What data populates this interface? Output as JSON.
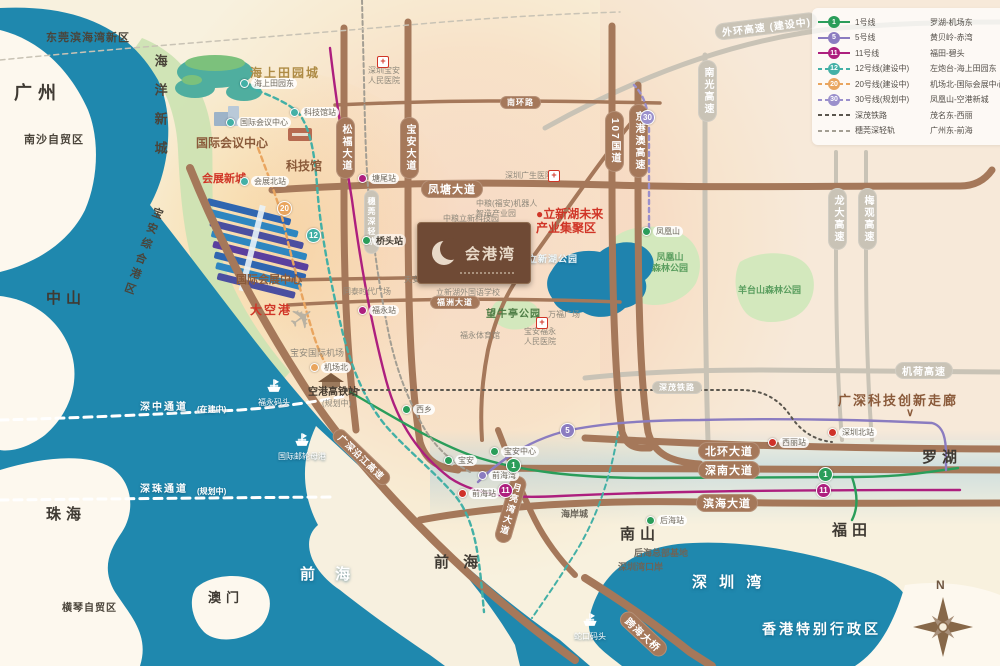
{
  "palette": {
    "sea": "#1f88ae",
    "land": "#f8f1de",
    "road_brown": "#a5785a",
    "road_gray": "#c9c3b6",
    "line1": "#2a9d5a",
    "line5": "#8b7cc0",
    "line11": "#ad1f7e",
    "line12": "#43b0a6",
    "line20": "#e9a55f",
    "line30": "#9b90cc",
    "rail_shenmao": "#5a564e",
    "rail_suiwan": "#a39e93",
    "highlight_red": "#d03527"
  },
  "logo": {
    "title": "会港湾"
  },
  "legend": {
    "rows": [
      {
        "badge": "1",
        "name": "1号线",
        "route": "罗湖-机场东",
        "c": "#2a9d5a",
        "cls": ""
      },
      {
        "badge": "5",
        "name": "5号线",
        "route": "黄贝岭-赤湾",
        "c": "#8b7cc0",
        "cls": ""
      },
      {
        "badge": "11",
        "name": "11号线",
        "route": "福田-碧头",
        "c": "#ad1f7e",
        "cls": ""
      },
      {
        "badge": "12",
        "name": "12号线(建设中)",
        "route": "左炮台-海上田园东",
        "c": "#43b0a6",
        "cls": "lg-dash"
      },
      {
        "badge": "20",
        "name": "20号线(建设中)",
        "route": "机场北-国际会展中心",
        "c": "#e9a55f",
        "cls": "lg-dash"
      },
      {
        "badge": "30",
        "name": "30号线(规划中)",
        "route": "凤凰山-空港新城",
        "c": "#9b90cc",
        "cls": "lg-dash"
      },
      {
        "badge": "",
        "name": "深茂铁路",
        "route": "茂名东-西丽",
        "c": "#5a564e",
        "cls": "lg-dash"
      },
      {
        "badge": "",
        "name": "穗莞深轻轨",
        "route": "广州东-前海",
        "c": "#a39e93",
        "cls": "lg-dash"
      }
    ]
  },
  "map_labels": [
    {
      "t": "东莞滨海湾新区",
      "x": 46,
      "y": 32,
      "cls": "dark-md"
    },
    {
      "t": "广州",
      "x": 14,
      "y": 83,
      "cls": "city-xl"
    },
    {
      "t": "南沙自贸区",
      "x": 24,
      "y": 134,
      "cls": "dark-md"
    },
    {
      "t": "中山",
      "x": 46,
      "y": 290,
      "cls": "city-lg"
    },
    {
      "t": "珠海",
      "x": 46,
      "y": 506,
      "cls": "city-lg"
    },
    {
      "t": "横琴自贸区",
      "x": 62,
      "y": 603,
      "cls": "dark-md",
      "fs": 10
    },
    {
      "t": "澳门",
      "x": 208,
      "y": 590,
      "cls": "city-lg",
      "fs": 13
    },
    {
      "t": "前 海",
      "x": 300,
      "y": 566,
      "cls": "white-lg"
    },
    {
      "t": "前 海",
      "x": 434,
      "y": 554,
      "cls": "city-lg"
    },
    {
      "t": "南山",
      "x": 620,
      "y": 526,
      "cls": "city-lg"
    },
    {
      "t": "福田",
      "x": 832,
      "y": 522,
      "cls": "city-lg"
    },
    {
      "t": "罗湖",
      "x": 922,
      "y": 449,
      "cls": "city-lg"
    },
    {
      "t": "深 圳 湾",
      "x": 692,
      "y": 574,
      "cls": "white-lg",
      "ls": 4
    },
    {
      "t": "香港特别行政区",
      "x": 762,
      "y": 621,
      "cls": "white-lg",
      "fs": 14,
      "ls": 3
    },
    {
      "t": "海洋新城",
      "x": 152,
      "y": 54,
      "cls": "vert-city"
    },
    {
      "t": "宝安综合港区",
      "x": 152,
      "y": 205,
      "cls": "vert-city",
      "rot": 20,
      "fs": 11,
      "ls": 5
    },
    {
      "t": "会展新城",
      "x": 202,
      "y": 173,
      "cls": "red-bold",
      "fs": 11
    },
    {
      "t": "大空港",
      "x": 250,
      "y": 303,
      "cls": "red-bold",
      "ls": 2
    },
    {
      "t": "●立新湖未来\n产业集聚区",
      "x": 536,
      "y": 207,
      "cls": "red-bold"
    },
    {
      "t": "海上田园城",
      "x": 250,
      "y": 66,
      "cls": "gold-bold"
    },
    {
      "t": "国际会议中心",
      "x": 196,
      "y": 136,
      "cls": "brown-bold"
    },
    {
      "t": "科技馆",
      "x": 286,
      "y": 159,
      "cls": "brown-bold"
    },
    {
      "t": "国际会展中心",
      "x": 236,
      "y": 274,
      "cls": "brown-bold",
      "fs": 11
    },
    {
      "t": "望牛亭公园",
      "x": 486,
      "y": 309,
      "cls": "park-strong"
    },
    {
      "t": "凤凰山\n森林公园",
      "x": 652,
      "y": 252,
      "cls": "park-txt"
    },
    {
      "t": "羊台山森林公园",
      "x": 738,
      "y": 285,
      "cls": "park-txt"
    },
    {
      "t": "立新湖公园",
      "x": 528,
      "y": 254,
      "cls": "white-sm"
    },
    {
      "t": "广深科技创新走廊",
      "x": 838,
      "y": 393,
      "cls": "brown-bold",
      "fs": 13,
      "ls": 2
    },
    {
      "t": "∨",
      "x": 906,
      "y": 407,
      "cls": "brown-bold",
      "fs": 11
    },
    {
      "t": "宝安国际机场",
      "x": 290,
      "y": 348,
      "cls": "gray-poi",
      "fs": 9
    },
    {
      "t": "空港高铁站",
      "x": 308,
      "y": 387,
      "cls": "station-name-lg"
    },
    {
      "t": "(规划中)",
      "x": 322,
      "y": 399,
      "cls": "gray-poi"
    },
    {
      "t": "后海总部基地",
      "x": 634,
      "y": 548,
      "cls": "dark-sm"
    },
    {
      "t": "深圳湾口岸",
      "x": 618,
      "y": 562,
      "cls": "dark-sm"
    },
    {
      "t": "海岸城",
      "x": 561,
      "y": 509,
      "cls": "dark-sm"
    },
    {
      "t": "深中通道",
      "x": 140,
      "y": 402,
      "cls": "white-rd"
    },
    {
      "t": "(在建中)",
      "x": 197,
      "y": 405,
      "cls": "white-rd",
      "fs": 8,
      "ls": 0
    },
    {
      "t": "深珠通道",
      "x": 140,
      "y": 484,
      "cls": "white-rd"
    },
    {
      "t": "(规划中)",
      "x": 197,
      "y": 487,
      "cls": "white-rd",
      "fs": 8,
      "ls": 0
    },
    {
      "t": "中粮(福安)机器人\n智造产业园",
      "x": 476,
      "y": 199,
      "cls": "gray-poi"
    },
    {
      "t": "中粮立新科技园",
      "x": 443,
      "y": 214,
      "cls": "gray-poi"
    },
    {
      "t": "天安数码城产业园",
      "x": 404,
      "y": 275,
      "cls": "gray-poi"
    },
    {
      "t": "立新湖外国语学校",
      "x": 436,
      "y": 288,
      "cls": "gray-poi"
    },
    {
      "t": "福永体育馆",
      "x": 460,
      "y": 331,
      "cls": "gray-poi"
    },
    {
      "t": "同泰时代广场",
      "x": 343,
      "y": 287,
      "cls": "gray-poi"
    },
    {
      "t": "万福广场",
      "x": 548,
      "y": 310,
      "cls": "gray-poi"
    },
    {
      "t": "深圳广生医院",
      "x": 505,
      "y": 171,
      "cls": "gray-poi"
    },
    {
      "t": "宝安福永\n人民医院",
      "x": 524,
      "y": 327,
      "cls": "gray-poi"
    },
    {
      "t": "深圳宝安\n人民医院",
      "x": 368,
      "y": 66,
      "cls": "gray-poi"
    },
    {
      "t": "✈",
      "x": 282,
      "y": 312,
      "cls": "plane",
      "rot": -36,
      "fs": 30
    },
    {
      "t": "N",
      "x": 936,
      "y": 578,
      "cls": "compass-n"
    }
  ],
  "road_pills": [
    {
      "t": "凤塘大道",
      "x": 421,
      "y": 180,
      "fs": 11
    },
    {
      "t": "南环路",
      "x": 500,
      "y": 96,
      "fs": 8
    },
    {
      "t": "桥和路",
      "x": 423,
      "y": 268,
      "fs": 8
    },
    {
      "t": "福洲大道",
      "x": 430,
      "y": 296,
      "fs": 8
    },
    {
      "t": "北环大道",
      "x": 698,
      "y": 442,
      "fs": 11
    },
    {
      "t": "深南大道",
      "x": 698,
      "y": 461,
      "fs": 11
    },
    {
      "t": "滨海大道",
      "x": 696,
      "y": 494,
      "fs": 11
    },
    {
      "t": "跨海大桥",
      "x": 628,
      "y": 608,
      "fs": 10,
      "rot": 43
    },
    {
      "t": "月亮湾大道",
      "x": 512,
      "y": 474,
      "v": 1,
      "fs": 9,
      "rot": 16
    },
    {
      "t": "广深沿江高速",
      "x": 340,
      "y": 426,
      "fs": 9,
      "rot": 44
    },
    {
      "t": "松福大道",
      "x": 336,
      "y": 117,
      "v": 1
    },
    {
      "t": "宝安大道",
      "x": 400,
      "y": 117,
      "v": 1
    },
    {
      "t": "107国道",
      "x": 605,
      "y": 111,
      "v": 1
    },
    {
      "t": "京港澳高速",
      "x": 629,
      "y": 104,
      "v": 1
    },
    {
      "t": "外环高速 (建设中)",
      "x": 714,
      "y": 24,
      "cls": "g",
      "fs": 10,
      "rot": -7
    },
    {
      "t": "南光高速",
      "x": 698,
      "y": 60,
      "cls": "g",
      "v": 1
    },
    {
      "t": "龙大高速",
      "x": 828,
      "y": 188,
      "cls": "g",
      "v": 1
    },
    {
      "t": "梅观高速",
      "x": 858,
      "y": 188,
      "cls": "g",
      "v": 1
    },
    {
      "t": "机荷高速",
      "x": 895,
      "y": 362,
      "cls": "g",
      "fs": 10
    },
    {
      "t": "深茂铁路",
      "x": 652,
      "y": 381,
      "cls": "g",
      "fs": 8
    },
    {
      "t": "穗莞深轻轨",
      "x": 364,
      "y": 190,
      "cls": "g",
      "v": 1,
      "fs": 8
    }
  ],
  "stations": [
    {
      "t": "海上田园东",
      "x": 240,
      "y": 78,
      "c": "#43b0a6"
    },
    {
      "t": "科技馆站",
      "x": 290,
      "y": 107,
      "c": "#43b0a6"
    },
    {
      "t": "国际会议中心",
      "x": 226,
      "y": 117,
      "c": "#43b0a6"
    },
    {
      "t": "会展北站",
      "x": 240,
      "y": 176,
      "c": "#43b0a6"
    },
    {
      "t": "塘尾站",
      "x": 358,
      "y": 173,
      "c": "#ad1f7e"
    },
    {
      "t": "桥头站",
      "x": 362,
      "y": 234,
      "c": "#2a9d5a",
      "b": 1
    },
    {
      "t": "福永站",
      "x": 358,
      "y": 305,
      "c": "#ad1f7e"
    },
    {
      "t": "机场北",
      "x": 310,
      "y": 362,
      "c": "#e9a55f"
    },
    {
      "t": "西乡",
      "x": 402,
      "y": 404,
      "c": "#2a9d5a"
    },
    {
      "t": "宝安",
      "x": 444,
      "y": 455,
      "c": "#2a9d5a"
    },
    {
      "t": "宝安中心",
      "x": 490,
      "y": 446,
      "c": "#2a9d5a"
    },
    {
      "t": "前海湾",
      "x": 478,
      "y": 470,
      "c": "#8b7cc0"
    },
    {
      "t": "前海站",
      "x": 458,
      "y": 488,
      "c": "#cf3128"
    },
    {
      "t": "后海站",
      "x": 646,
      "y": 515,
      "c": "#2a9d5a"
    },
    {
      "t": "西丽站",
      "x": 768,
      "y": 437,
      "c": "#cf3128"
    },
    {
      "t": "深圳北站",
      "x": 828,
      "y": 427,
      "c": "#cf3128"
    },
    {
      "t": "凤凰山",
      "x": 642,
      "y": 226,
      "c": "#2a9d5a"
    }
  ],
  "badges": [
    {
      "n": "1",
      "x": 818,
      "y": 467,
      "c": "#2a9d5a"
    },
    {
      "n": "11",
      "x": 816,
      "y": 483,
      "c": "#ad1f7e"
    },
    {
      "n": "5",
      "x": 560,
      "y": 423,
      "c": "#8b7cc0"
    },
    {
      "n": "1",
      "x": 506,
      "y": 458,
      "c": "#2a9d5a"
    },
    {
      "n": "11",
      "x": 498,
      "y": 483,
      "c": "#ad1f7e"
    },
    {
      "n": "20",
      "x": 277,
      "y": 201,
      "c": "#e9a55f"
    },
    {
      "n": "12",
      "x": 306,
      "y": 228,
      "c": "#43b0a6"
    },
    {
      "n": "30",
      "x": 640,
      "y": 110,
      "c": "#9b90cc"
    }
  ],
  "piers": [
    {
      "t": "福永码头",
      "x": 258,
      "y": 376
    },
    {
      "t": "国际邮轮母港",
      "x": 278,
      "y": 430
    },
    {
      "t": "蛇口码头",
      "x": 574,
      "y": 610
    }
  ],
  "crosses": [
    {
      "x": 548,
      "y": 170
    },
    {
      "x": 536,
      "y": 317
    },
    {
      "x": 377,
      "y": 56
    }
  ]
}
